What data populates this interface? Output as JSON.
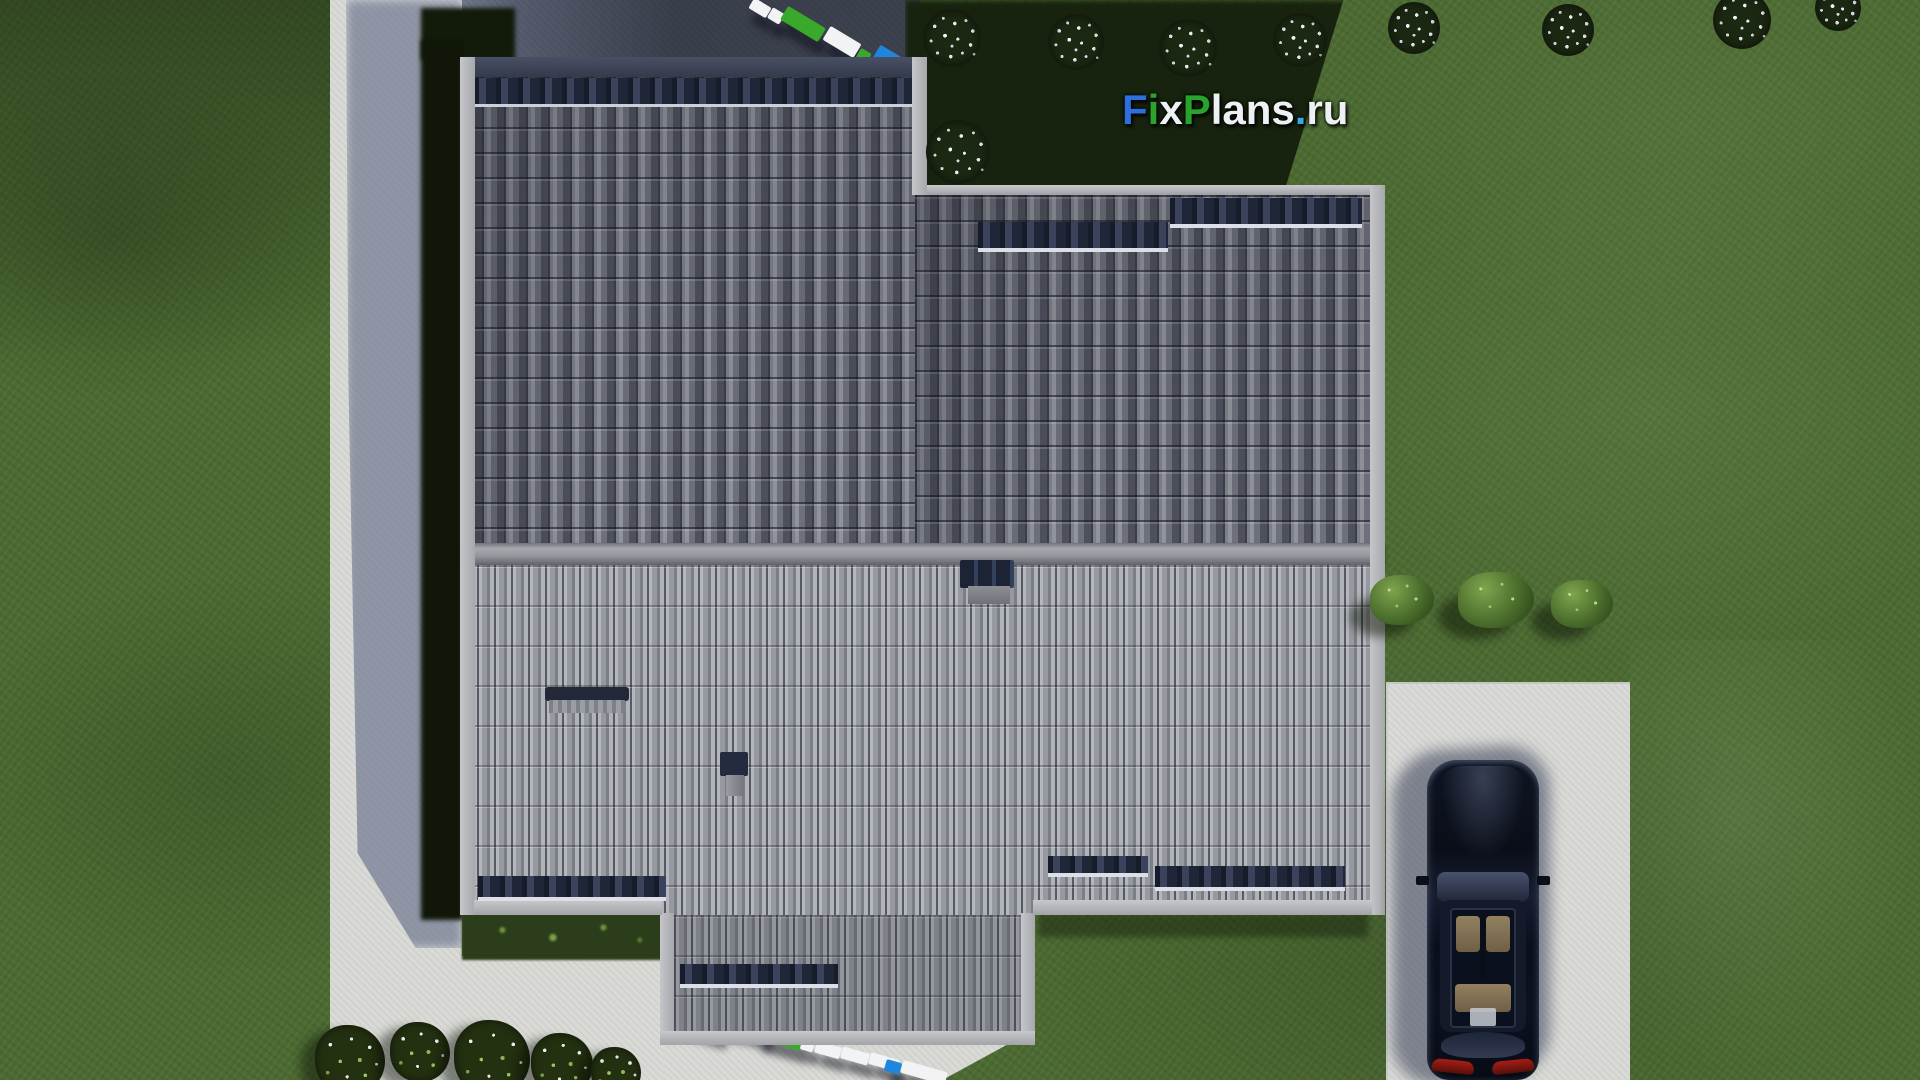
{
  "logo": {
    "text": "FixPlans.ru",
    "segments": [
      {
        "text": "F",
        "color": "#2e6fdf"
      },
      {
        "text": "i",
        "color": "#2da32c"
      },
      {
        "text": "x",
        "color": "#eef1f4"
      },
      {
        "text": "P",
        "color": "#28a32c"
      },
      {
        "text": "lans",
        "color": "#eef1f4"
      },
      {
        "text": ".",
        "color": "#38a7e8"
      },
      {
        "text": "ru",
        "color": "#eef1f4"
      }
    ]
  },
  "palette": {
    "grass": "#4c6a32",
    "grass_shadow": "#17230e",
    "concrete": "#d9dad6",
    "concrete_shadow": "#8b93a8",
    "pavement_dark": "#3a3f4c",
    "roof_upper": "#7d8089",
    "roof_lower": "#9da0a6",
    "roof_dark_row": "#232a3c",
    "fascia": "#b4b6ba",
    "car_body": "#0c1220",
    "car_seats": "#8d7b5e",
    "taillight": "#8a1612",
    "watermark_blue": "#1f86dd",
    "watermark_green": "#3aa82b",
    "watermark_white": "#f2f3f5"
  },
  "scene": {
    "view": "top-down 3d render",
    "objects": [
      "house-roof",
      "lawn",
      "west-path",
      "south-path",
      "north-pavement",
      "driveway",
      "black-car",
      "flowering-bushes",
      "green-bushes",
      "ground-watermark-text"
    ]
  },
  "decor": {
    "bushes_white": [
      {
        "x": 952,
        "y": 38,
        "s": 58
      },
      {
        "x": 1076,
        "y": 42,
        "s": 56
      },
      {
        "x": 1188,
        "y": 48,
        "s": 58
      },
      {
        "x": 1300,
        "y": 40,
        "s": 54
      },
      {
        "x": 1414,
        "y": 28,
        "s": 52
      },
      {
        "x": 958,
        "y": 152,
        "s": 64
      },
      {
        "x": 1568,
        "y": 30,
        "s": 52
      },
      {
        "x": 1742,
        "y": 20,
        "s": 58
      },
      {
        "x": 1838,
        "y": 8,
        "s": 46
      }
    ],
    "bushes_green": [
      {
        "x": 1402,
        "y": 600,
        "w": 64,
        "h": 50
      },
      {
        "x": 1496,
        "y": 600,
        "w": 76,
        "h": 56
      },
      {
        "x": 1582,
        "y": 604,
        "w": 62,
        "h": 48
      }
    ],
    "bushes_mixed": [
      {
        "x": 350,
        "y": 1060,
        "s": 70
      },
      {
        "x": 420,
        "y": 1052,
        "s": 60
      },
      {
        "x": 492,
        "y": 1058,
        "s": 76
      },
      {
        "x": 562,
        "y": 1064,
        "s": 62
      },
      {
        "x": 616,
        "y": 1072,
        "s": 50
      }
    ],
    "wm_top": [
      {
        "x": 750,
        "y": 2,
        "w": 20,
        "h": 12,
        "c": "white",
        "r": 31
      },
      {
        "x": 769,
        "y": 10,
        "w": 14,
        "h": 12,
        "c": "white",
        "r": 31
      },
      {
        "x": 781,
        "y": 16,
        "w": 44,
        "h": 16,
        "c": "green",
        "r": 31
      },
      {
        "x": 824,
        "y": 34,
        "w": 36,
        "h": 16,
        "c": "white",
        "r": 31
      },
      {
        "x": 857,
        "y": 50,
        "w": 12,
        "h": 14,
        "c": "green",
        "r": 31
      },
      {
        "x": 868,
        "y": 54,
        "w": 46,
        "h": 36,
        "c": "blue",
        "r": 31
      }
    ],
    "wm_bottom": [
      {
        "x": 686,
        "y": 1006,
        "w": 38,
        "h": 26,
        "c": "blue",
        "r": 16
      },
      {
        "x": 724,
        "y": 1018,
        "w": 16,
        "h": 12,
        "c": "green",
        "r": 16
      },
      {
        "x": 740,
        "y": 1022,
        "w": 28,
        "h": 13,
        "c": "white",
        "r": 16
      },
      {
        "x": 757,
        "y": 1029,
        "w": 46,
        "h": 16,
        "c": "green",
        "r": 16
      },
      {
        "x": 801,
        "y": 1040,
        "w": 13,
        "h": 11,
        "c": "white",
        "r": 16
      },
      {
        "x": 815,
        "y": 1044,
        "w": 26,
        "h": 12,
        "c": "white",
        "r": 16
      },
      {
        "x": 841,
        "y": 1050,
        "w": 28,
        "h": 12,
        "c": "white",
        "r": 16
      },
      {
        "x": 869,
        "y": 1056,
        "w": 30,
        "h": 12,
        "c": "white",
        "r": 16
      },
      {
        "x": 885,
        "y": 1061,
        "w": 16,
        "h": 12,
        "c": "blue",
        "r": 16
      },
      {
        "x": 901,
        "y": 1066,
        "w": 46,
        "h": 13,
        "c": "white",
        "r": 16
      }
    ]
  }
}
